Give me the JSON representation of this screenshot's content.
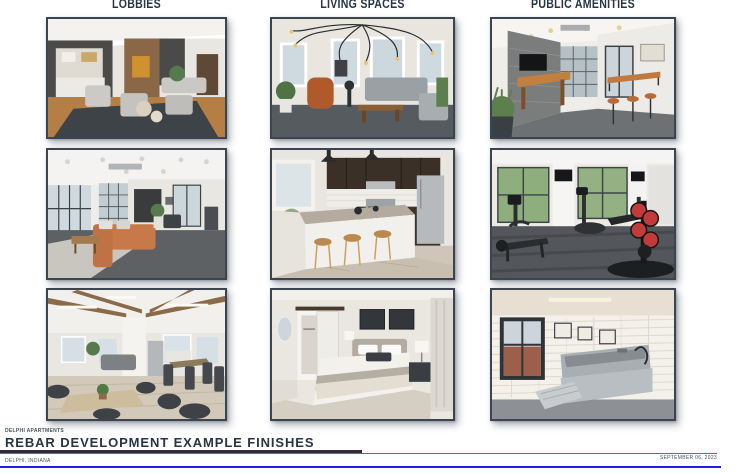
{
  "columns": [
    {
      "id": "lobbies",
      "label": "LOBBIES"
    },
    {
      "id": "living-spaces",
      "label": "LIVING SPACES"
    },
    {
      "id": "public-amenities",
      "label": "PUBLIC AMENITIES"
    }
  ],
  "photos": [
    {
      "column": "LOBBIES",
      "row": 1,
      "description": "Lobby lounge with charcoal accent walls, light gray armchairs, dark area rug, wood floor and white built-in cabinets"
    },
    {
      "column": "LIVING SPACES",
      "row": 1,
      "description": "Living room with white walls, large windows, sprawling Edison-bulb chandelier, rust velvet chair, gray sofa and wood coffee table"
    },
    {
      "column": "PUBLIC AMENITIES",
      "row": 1,
      "description": "Community game room with gray brick wall, wall-mounted TV, shuffleboard table, glass garage door and wood bar counter with stools"
    },
    {
      "column": "LOBBIES",
      "row": 2,
      "description": "Co-working lounge with glass garage doors, orange sectional sofa, light rug over gray carpet and kitchenette"
    },
    {
      "column": "LIVING SPACES",
      "row": 2,
      "description": "Kitchen with dark espresso cabinets, stainless appliances, white subway tile, granite-top white island and three wood bar stools"
    },
    {
      "column": "PUBLIC AMENITIES",
      "row": 2,
      "description": "Fitness center with cardio machines, mounted TVs on white columns, large windows and red and black weight plates"
    },
    {
      "column": "LOBBIES",
      "row": 3,
      "description": "Resident lounge with wood ceiling beams, white columns, cafe tables with dark chairs and bright windows"
    },
    {
      "column": "LIVING SPACES",
      "row": 3,
      "description": "Bedroom with upholstered headboard, layered bedding, dark art frames, barn-door closet, nightstand and lamps"
    },
    {
      "column": "PUBLIC AMENITIES",
      "row": 3,
      "description": "Pet wash room with stainless steel dog tub, ramp steps, white subway tile walls, framed pet prints and black-framed window"
    }
  ],
  "footer": {
    "project_label": "DELPHI APARTMENTS",
    "title": "REBAR DEVELOPMENT EXAMPLE FINISHES",
    "location": "DELPHI, INDIANA",
    "date": "SEPTEMBER 06, 2023"
  },
  "colors": {
    "heading": "#263645",
    "accent_red": "#e23b3b",
    "accent_blue": "#2121d6",
    "rule_dark": "#2f2d35",
    "photo_border": "#3c4450",
    "text_muted": "#47525c"
  }
}
